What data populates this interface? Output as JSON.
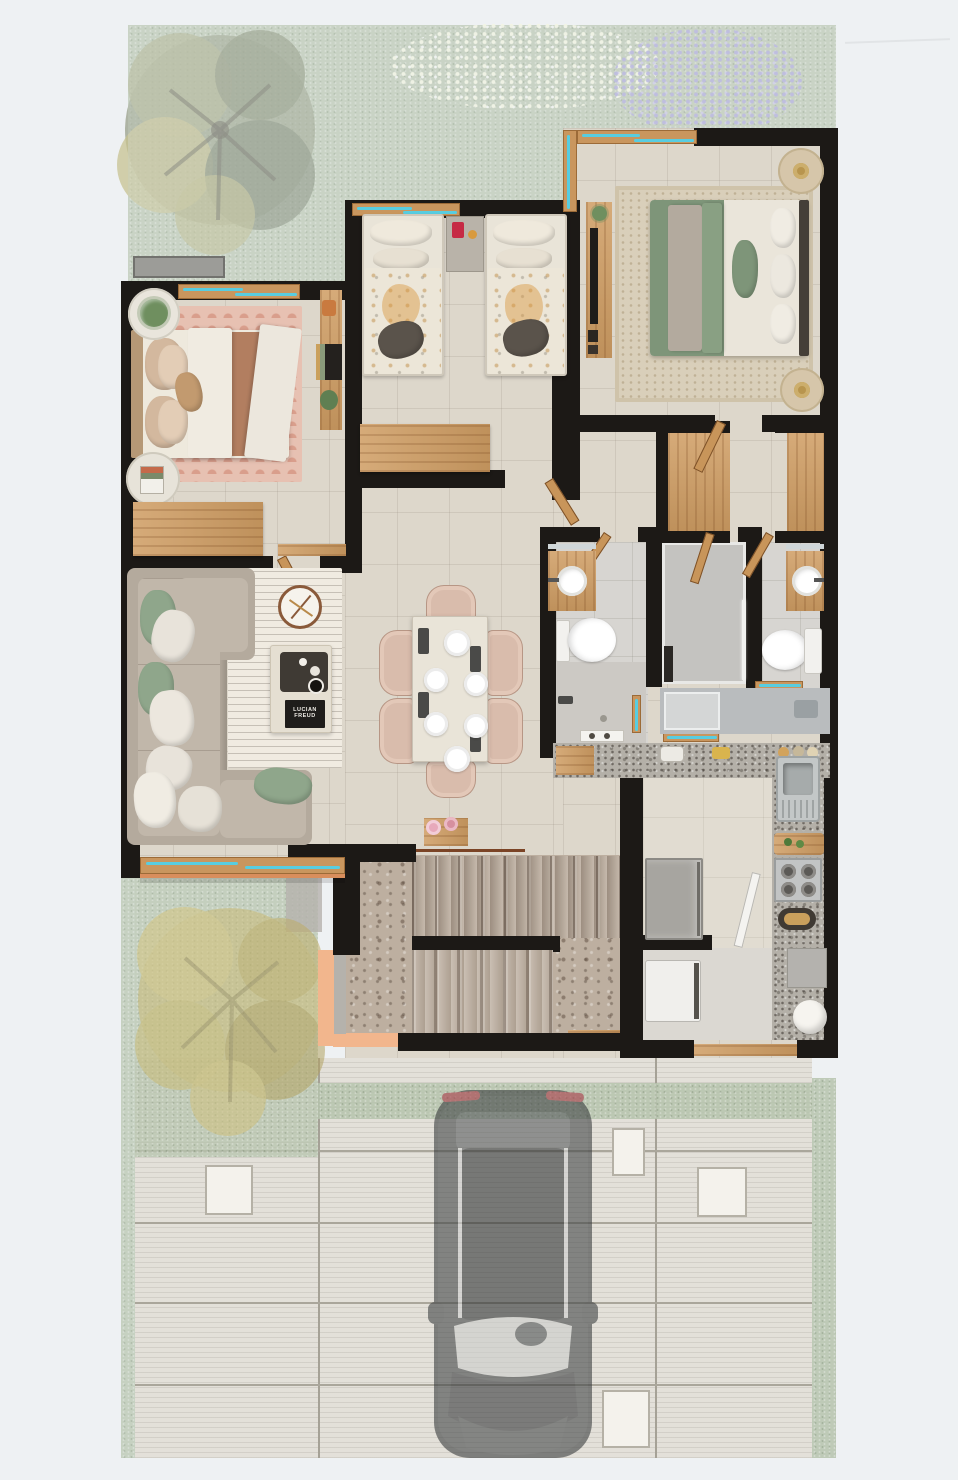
{
  "meta": {
    "type": "architectural-floor-plan",
    "view": "top-down 3d render",
    "level": "ground floor with front driveway and gardens"
  },
  "living_room": {
    "book_title": "LUCIAN FREUD"
  },
  "palette": {
    "background": "#eef1f3",
    "wall": "#1c1916",
    "floor_travertine": "#ddd7cb",
    "floor_bath": "#d7d5d1",
    "terrazzo_stairs": "#bdafa0",
    "granite_counter": "#b4b0a8",
    "wood_oak": "#cf9d63",
    "window_glass": "#58cde0",
    "grass_north": "#b6c4ad",
    "grass_south": "#afbda6",
    "lavender_patch": "#a6a3d6",
    "white_flower_patch": "#f3f5e0",
    "rug_pink": "#e7c1b2",
    "rug_master": "#d9cfba",
    "rug_living": "#f0ebe1",
    "sofa": "#b4aa9d",
    "sage_green": "#7e9579",
    "blush_chair": "#d9bcac",
    "peach_sill": "#f2b68d",
    "driveway": "#e3e0d9",
    "paver": "#f4f2ec",
    "car_body": "#35383a",
    "taillight_red": "#b03040"
  },
  "rooms": [
    {
      "name": "north-garden",
      "items": [
        "tree",
        "white-flower-bed",
        "lavender-bed",
        "doormat"
      ]
    },
    {
      "name": "master-bedroom",
      "items": [
        "double-bed-sage",
        "area-rug",
        "nightstand-lamp-top",
        "nightstand-lamp-bottom",
        "tv-console",
        "plant"
      ]
    },
    {
      "name": "kids-bedroom",
      "items": [
        "single-bed-left",
        "single-bed-right",
        "nightstand",
        "red-lamp",
        "desk"
      ]
    },
    {
      "name": "guest-bedroom",
      "items": [
        "double-bed",
        "scallop-rug",
        "plant-side-table",
        "book-side-table",
        "wall-shelf",
        "desk",
        "console-shelf"
      ]
    },
    {
      "name": "living-room",
      "items": [
        "l-shaped-sofa",
        "striped-rug",
        "coffee-table",
        "serving-tray",
        "art-book",
        "decor-clock"
      ]
    },
    {
      "name": "dining-room",
      "items": [
        "table-for-six",
        "chairs-x6",
        "place-settings-x6"
      ]
    },
    {
      "name": "bathroom-left",
      "items": [
        "vanity-sink",
        "toilet",
        "shower"
      ]
    },
    {
      "name": "walk-in-shower-room",
      "items": [
        "glass-shower"
      ]
    },
    {
      "name": "bathroom-right",
      "items": [
        "vanity-sink",
        "toilet"
      ]
    },
    {
      "name": "closet-corridor",
      "items": [
        "wardrobe-left",
        "wardrobe-right"
      ]
    },
    {
      "name": "service-patio",
      "items": [
        "counter",
        "utility-sink",
        "windows"
      ]
    },
    {
      "name": "kitchen",
      "items": [
        "granite-counter",
        "steel-sink",
        "cutting-board",
        "gas-stove",
        "bread-tray",
        "fridge",
        "open-door"
      ]
    },
    {
      "name": "entry-laundry",
      "items": [
        "washer",
        "planter-pot",
        "doormat",
        "wood-threshold"
      ]
    },
    {
      "name": "staircase",
      "items": [
        "upper-flight",
        "landing",
        "lower-flight",
        "handrail",
        "peach-planter-edge"
      ]
    },
    {
      "name": "south-garden",
      "items": [
        "yellow-tree",
        "gray-path"
      ]
    },
    {
      "name": "driveway",
      "items": [
        "suv-car",
        "white-pavers-x4",
        "grass-strips"
      ]
    }
  ]
}
